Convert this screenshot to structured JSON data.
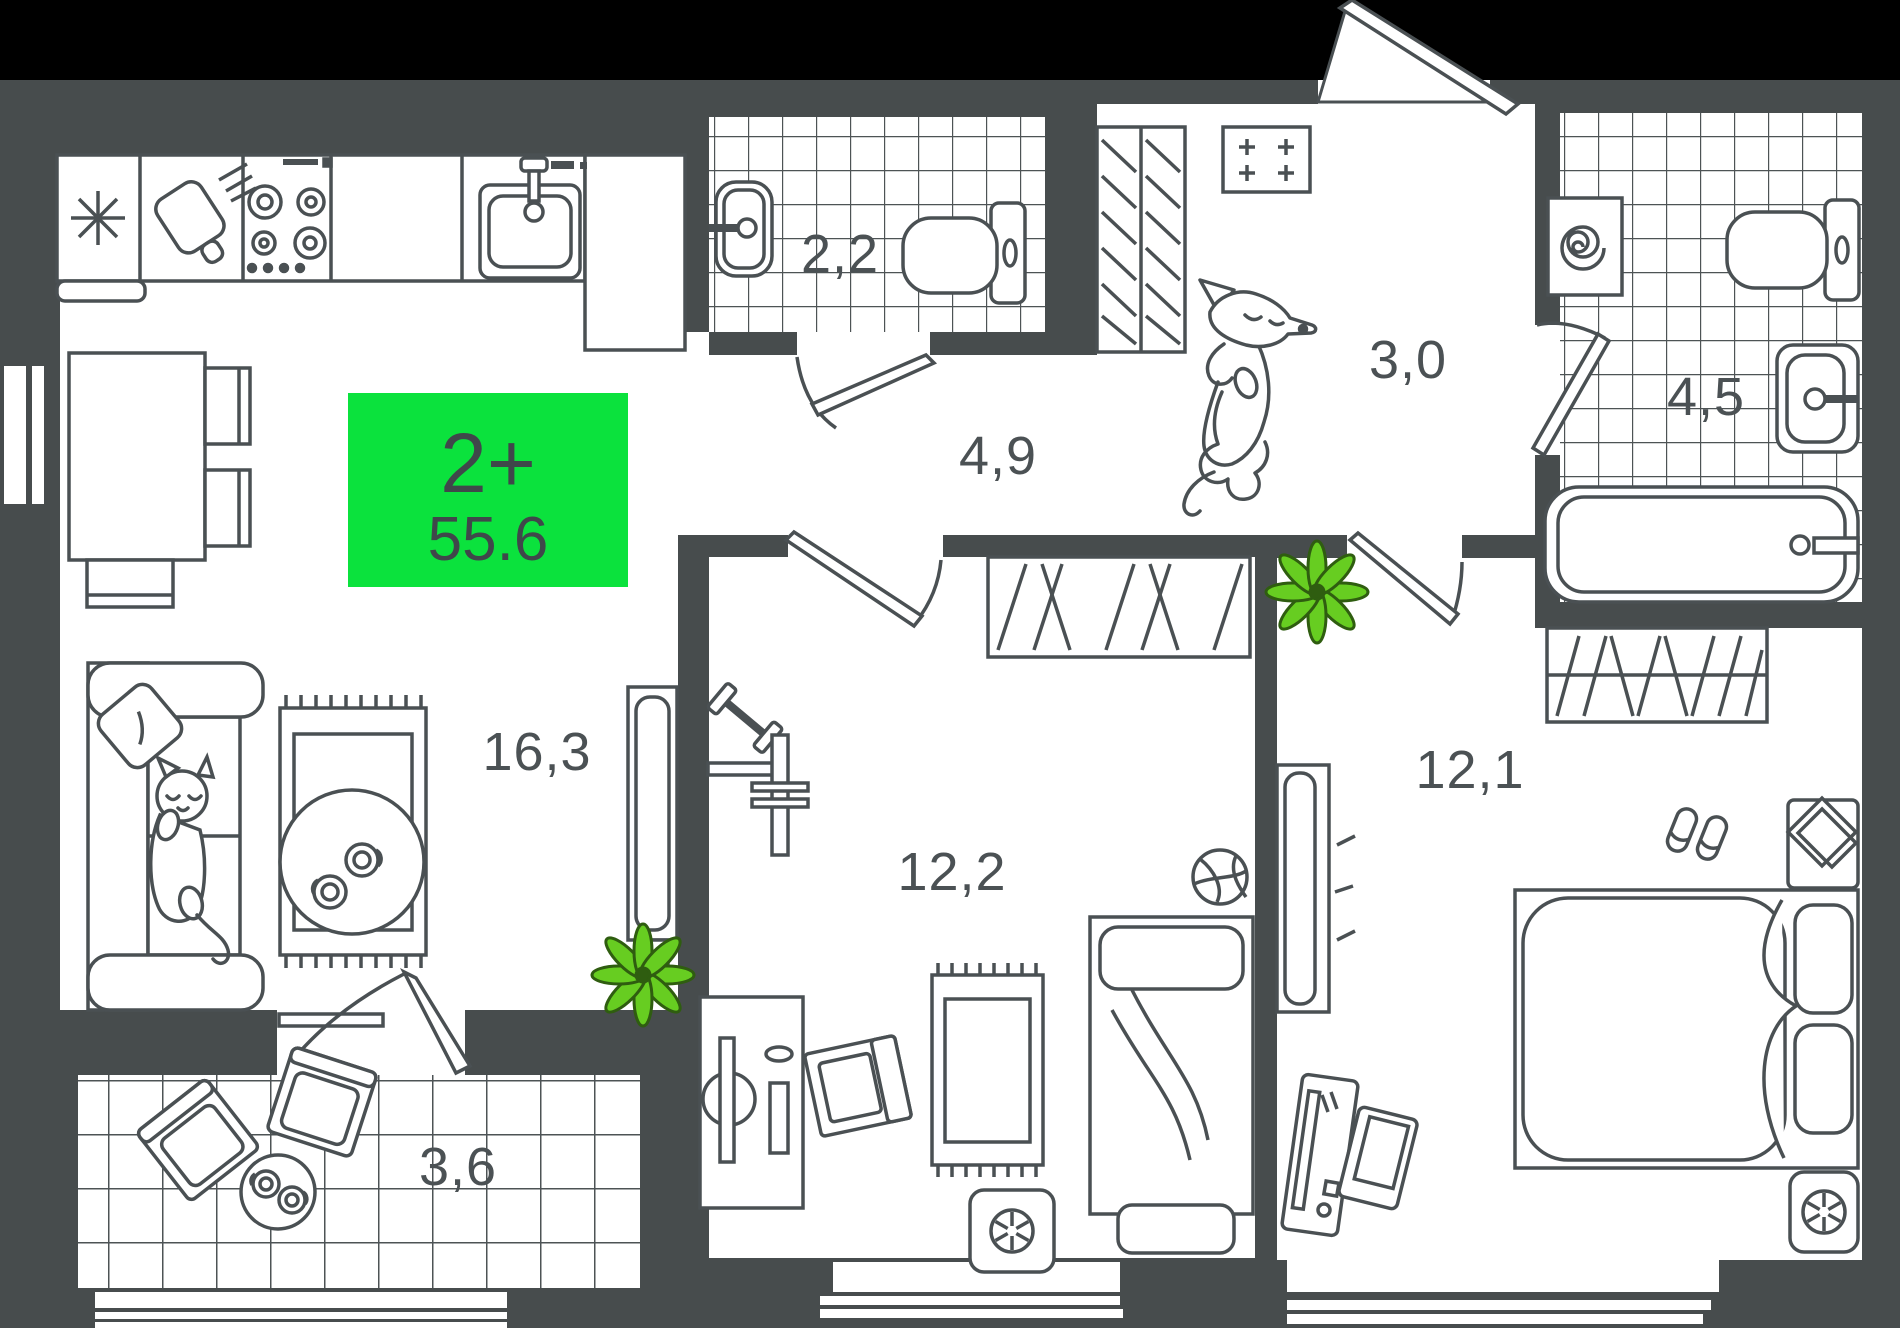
{
  "plan": {
    "title": "2-room apartment floor plan",
    "type_badge": {
      "label": "2+",
      "area": "55.6"
    },
    "rooms": [
      {
        "id": "kitchen-living",
        "area_label": "16,3"
      },
      {
        "id": "bathroom-small",
        "area_label": "2,2"
      },
      {
        "id": "hallway",
        "area_label": "4,9"
      },
      {
        "id": "entry-hall",
        "area_label": "3,0"
      },
      {
        "id": "bathroom-large",
        "area_label": "4,5"
      },
      {
        "id": "bedroom-middle",
        "area_label": "12,2"
      },
      {
        "id": "bedroom-right",
        "area_label": "12,1"
      },
      {
        "id": "balcony",
        "area_label": "3,6"
      }
    ],
    "icons": {
      "fridge": "snowflake-asterisk",
      "cutting-board": "tilted board with motion lines",
      "stove": "four burner circles with knobs",
      "kitchen-sink": "basin with faucet",
      "toilet": "bowl with cistern",
      "washing-machine": "box with spiral drum",
      "bathtub": "rounded tub with drain",
      "wardrobe": "hatched rectangle",
      "air-conditioner": "box with fan",
      "plant": "eight leaf star",
      "dog": "dog lying on back",
      "cat": "cat sleeping on sofa",
      "basketball": "ball",
      "slippers": "pair of slippers",
      "dumbbell": "crossed weight"
    },
    "colors": {
      "background": "#474C4D",
      "top_band": "#000000",
      "floor": "#FFFFFF",
      "line": "#4A5053",
      "tile_line": "#4D5355",
      "label_text": "#4B5154",
      "accent_green": "#0BE23D",
      "badge_text": "#3F474A",
      "plant_green": "#67CD21",
      "plant_outline": "#2F5D10"
    }
  }
}
